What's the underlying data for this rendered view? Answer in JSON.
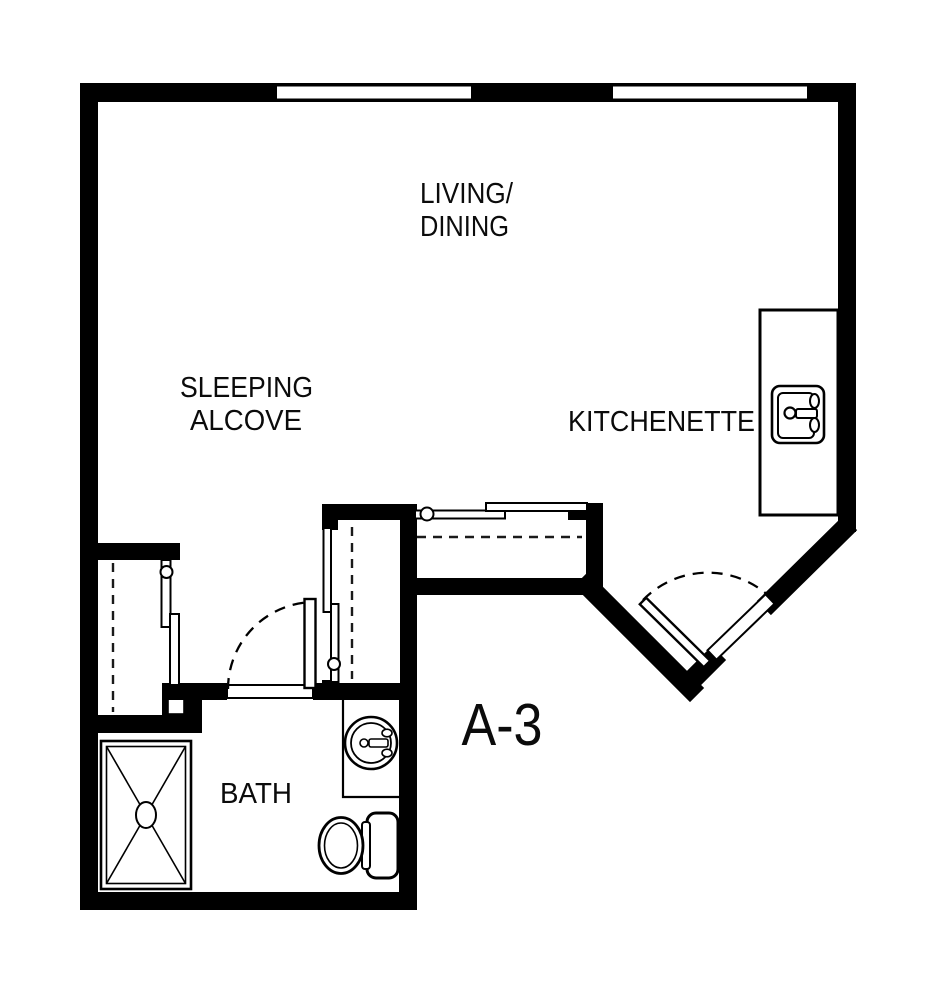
{
  "title": "Unit floor plan",
  "colors": {
    "wall": "#000000",
    "background": "#ffffff",
    "label": "#0b0b0b"
  },
  "unit": {
    "label": "A-3"
  },
  "rooms": {
    "living_dining": {
      "line1": "LIVING/",
      "line2": "DINING"
    },
    "sleeping_alcove": {
      "line1": "SLEEPING",
      "line2": "ALCOVE"
    },
    "kitchenette": {
      "label": "KITCHENETTE"
    },
    "bath": {
      "label": "BATH"
    }
  },
  "fixtures": {
    "kitchen_sink": "kitchen-sink-icon",
    "bath_sink": "round-sink-icon",
    "toilet": "toilet-icon",
    "shower": "shower-icon",
    "windows": 2,
    "swing_doors": 2,
    "sliding_closets": 3
  }
}
